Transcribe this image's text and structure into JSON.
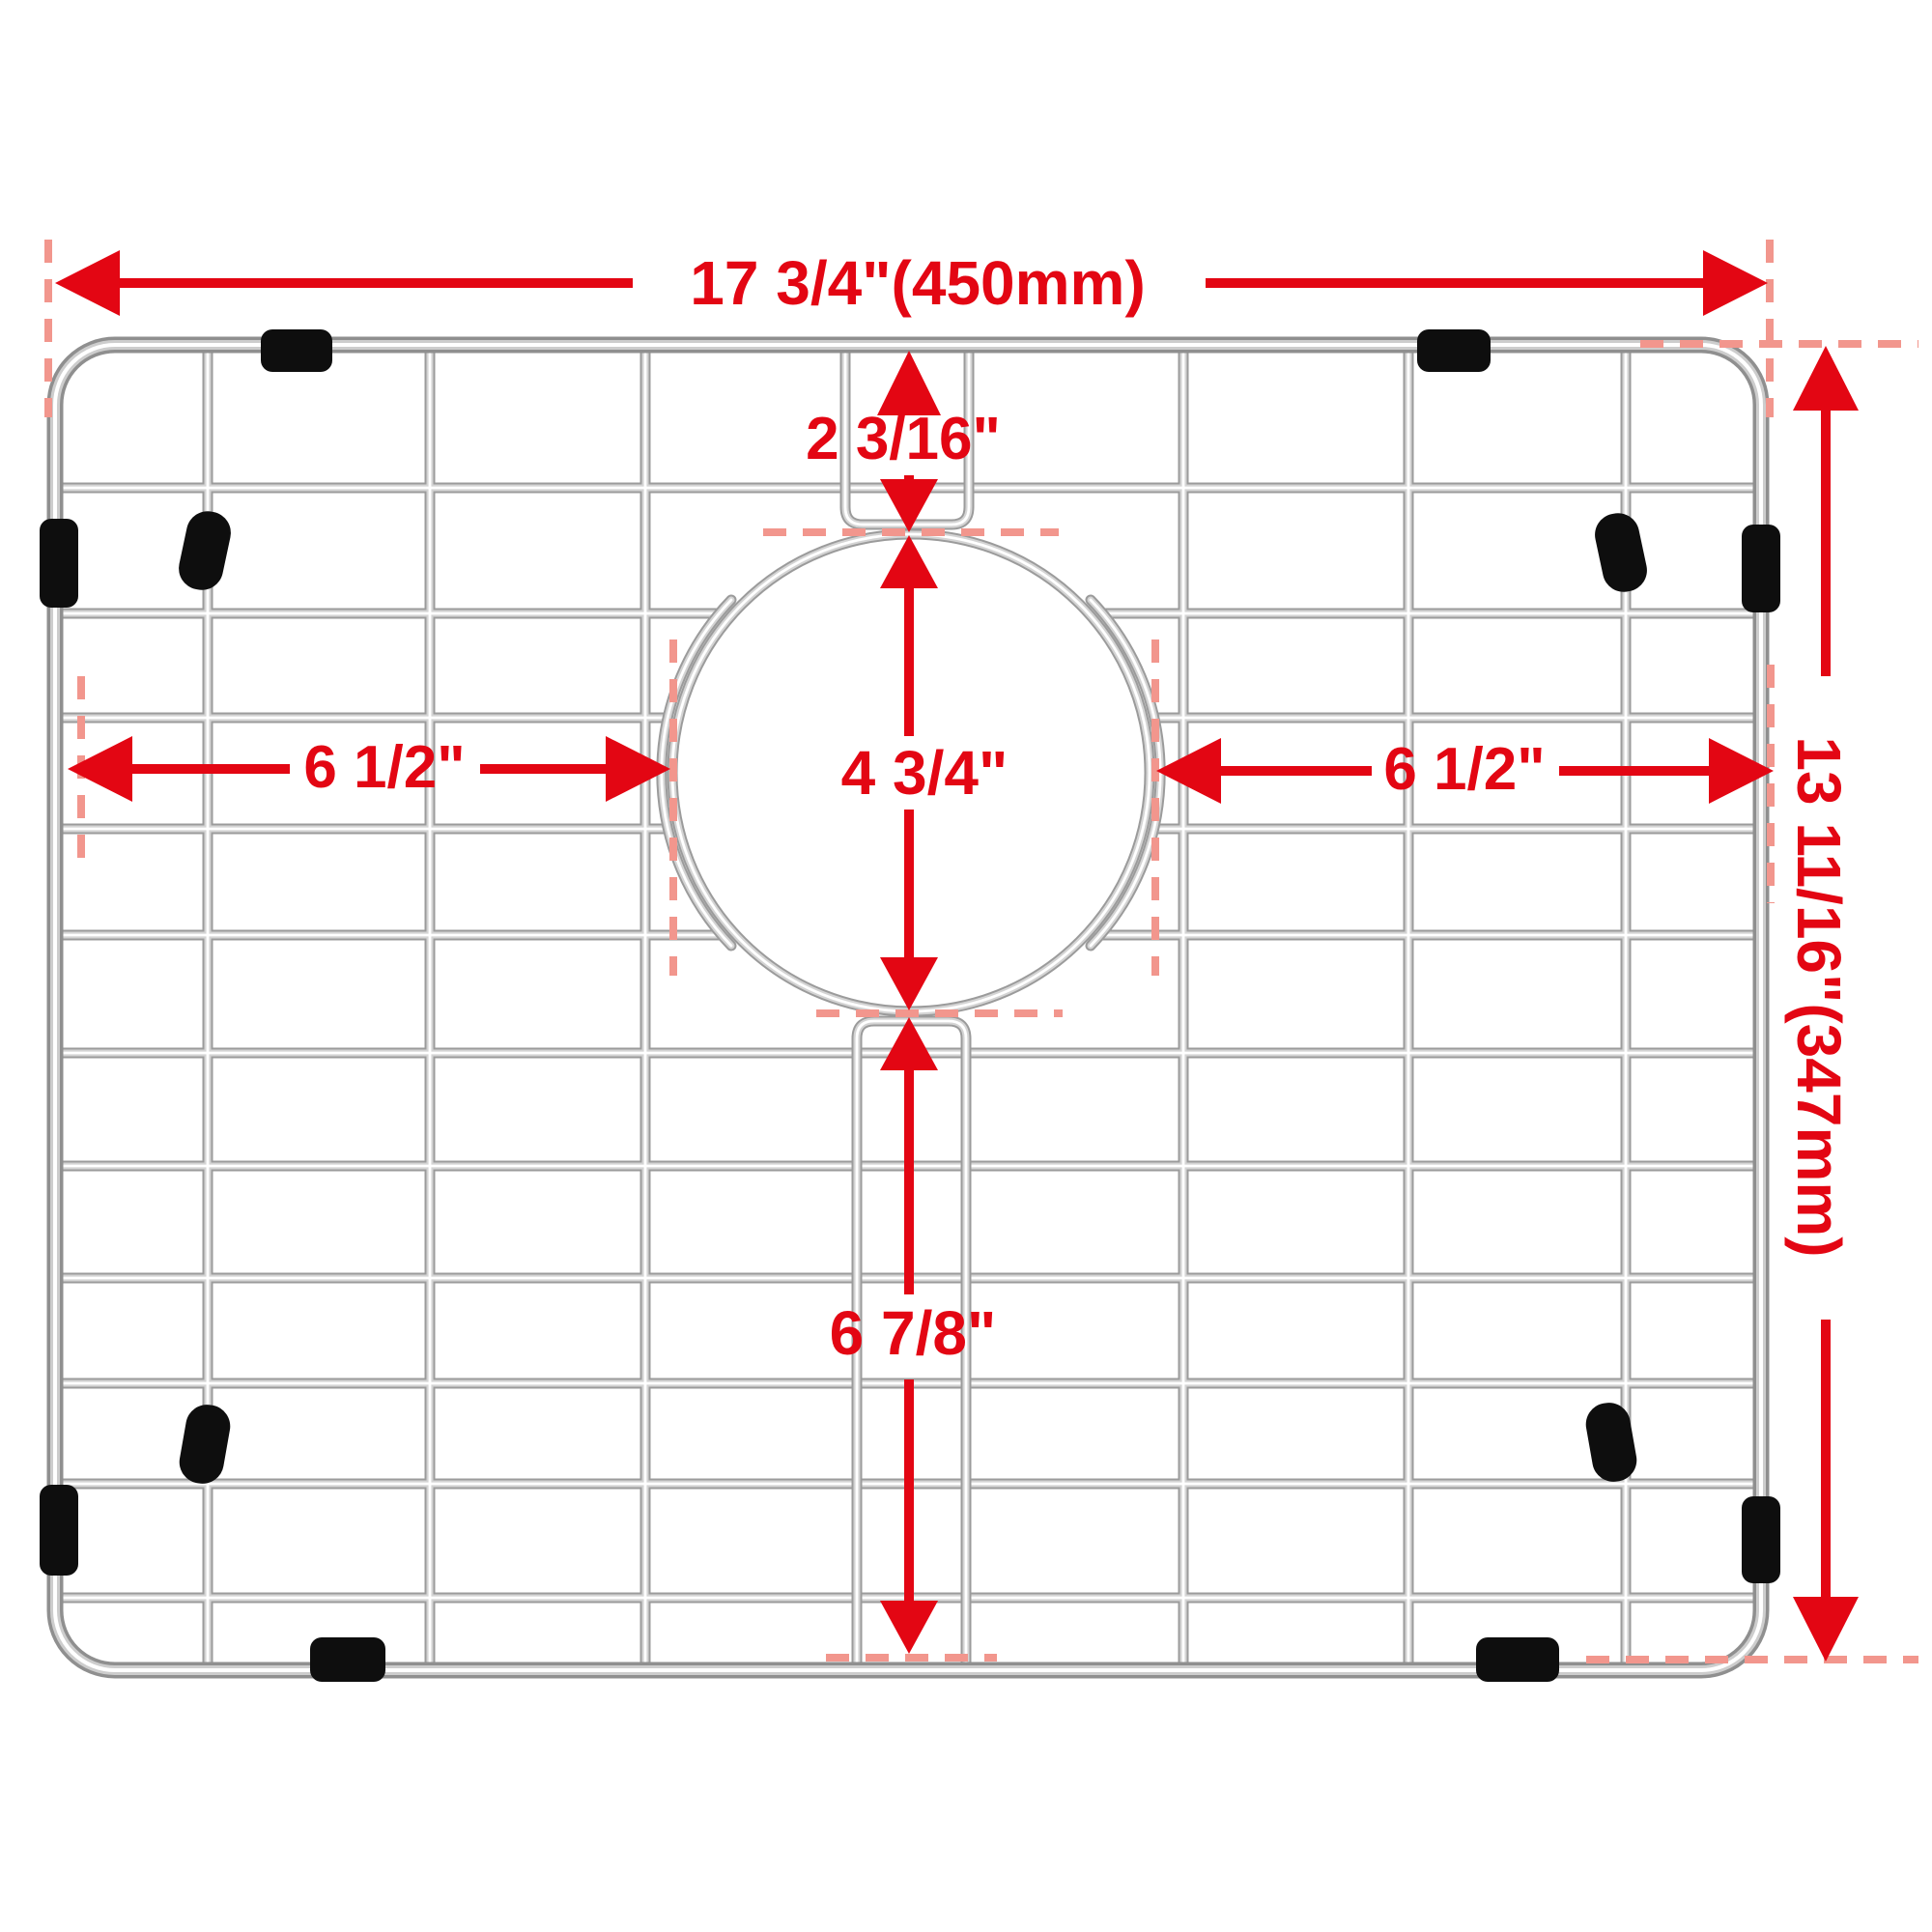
{
  "diagram": {
    "title": "sink bottom grid dimension diagram",
    "colors": {
      "dimension_red": "#e30613",
      "extension_pink": "#f2968d",
      "wire_steel": "#9b9b9b",
      "rubber_black": "#0e0e0e",
      "background": "#ffffff"
    },
    "dimensions": {
      "overall_width": "17 3/4\"(450mm)",
      "overall_height": "13 11/16\"(347mm)",
      "top_to_hole": "2 3/16\"",
      "hole_diameter": "4 3/4\"",
      "left_to_hole": "6 1/2\"",
      "hole_to_right": "6 1/2\"",
      "hole_to_bottom": "6 7/8\""
    }
  }
}
